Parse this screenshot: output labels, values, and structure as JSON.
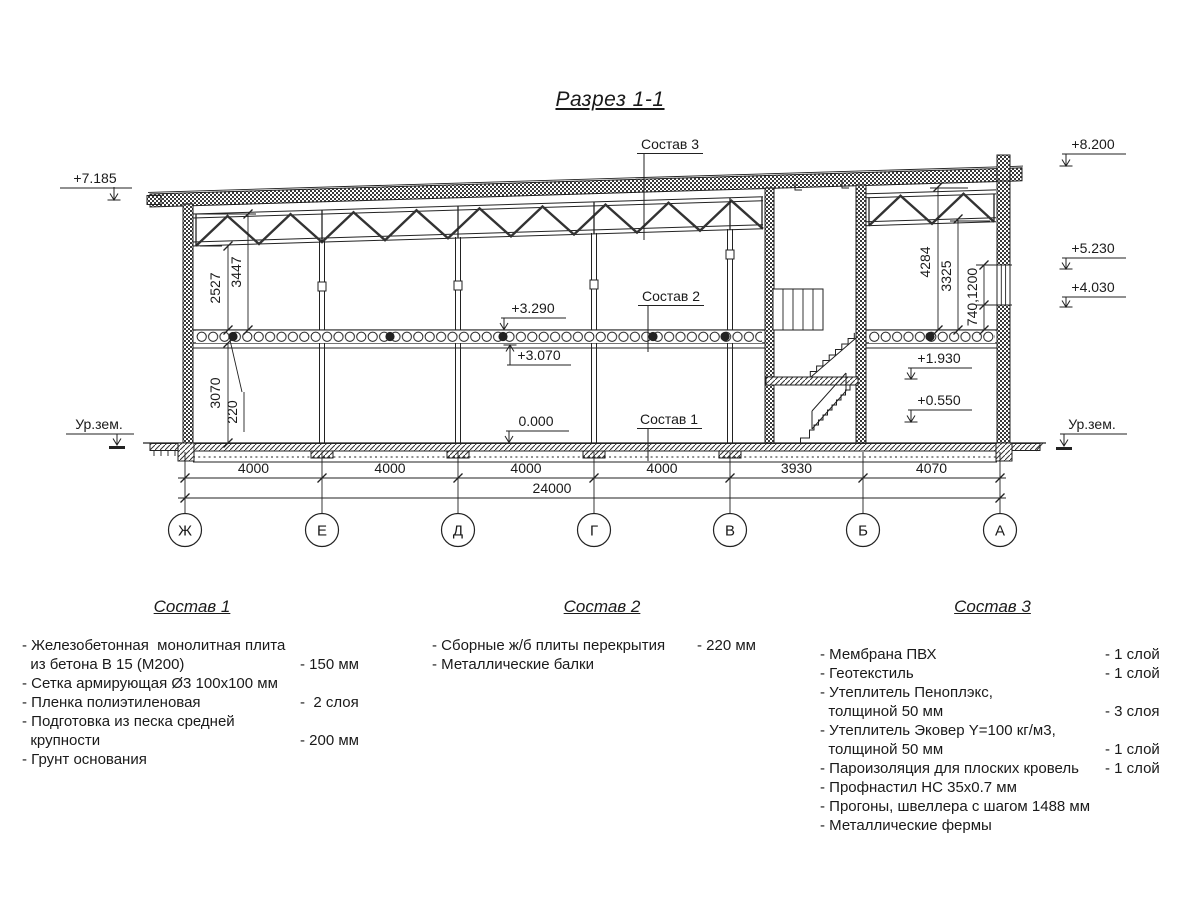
{
  "title": "Разрез 1-1",
  "drawing": {
    "elevations": {
      "left_roof": "+7.185",
      "right_parapet": "+8.200",
      "right_truss": "+5.230",
      "right_window": "+4.030",
      "slab_top": "+3.290",
      "slab_bottom": "+3.070",
      "floor_zero": "0.000",
      "stair_landing": "+1.930",
      "entry_level": "+0.550",
      "ground_left": "Ур.зем.",
      "ground_right": "Ур.зем."
    },
    "section_labels": {
      "s1": "Состав 1",
      "s2": "Состав 2",
      "s3": "Состав 3"
    },
    "dims": {
      "spans": [
        "4000",
        "4000",
        "4000",
        "4000",
        "3930",
        "4070"
      ],
      "total": "24000",
      "left_vertical": [
        "2527",
        "3447",
        "220",
        "3070"
      ],
      "right_vertical": [
        "4284",
        "3325",
        "740,1200"
      ]
    },
    "axes": [
      "Ж",
      "Е",
      "Д",
      "Г",
      "В",
      "Б",
      "А"
    ]
  },
  "compositions": [
    {
      "title": "Состав 1",
      "rows": [
        {
          "t": "- Железобетонная  монолитная плита",
          "v": ""
        },
        {
          "t": "  из бетона В 15 (М200)",
          "v": "- 150 мм"
        },
        {
          "t": "- Сетка армирующая Ø3 100x100 мм",
          "v": ""
        },
        {
          "t": "- Пленка полиэтиленовая",
          "v": "-  2 слоя"
        },
        {
          "t": "- Подготовка из песка средней",
          "v": ""
        },
        {
          "t": "  крупности",
          "v": "- 200 мм"
        },
        {
          "t": "- Грунт основания",
          "v": ""
        }
      ]
    },
    {
      "title": "Состав 2",
      "rows": [
        {
          "t": "- Сборные ж/б плиты перекрытия",
          "v": "- 220 мм"
        },
        {
          "t": "- Металлические балки",
          "v": ""
        }
      ]
    },
    {
      "title": "Состав 3",
      "rows": [
        {
          "t": "- Мембрана ПВХ",
          "v": "- 1 слой"
        },
        {
          "t": "- Геотекстиль",
          "v": "- 1 слой"
        },
        {
          "t": "- Утеплитель Пеноплэкс,",
          "v": ""
        },
        {
          "t": "  толщиной 50 мм",
          "v": "- 3 слоя"
        },
        {
          "t": "- Утеплитель Эковер Y=100 кг/м3,",
          "v": ""
        },
        {
          "t": "  толщиной 50 мм",
          "v": "- 1 слой"
        },
        {
          "t": "- Пароизоляция для плоских кровель",
          "v": "- 1 слой"
        },
        {
          "t": "- Профнастил НС 35x0.7 мм",
          "v": ""
        },
        {
          "t": "- Прогоны, швеллера с шагом 1488 мм",
          "v": ""
        },
        {
          "t": "- Металлические фермы",
          "v": ""
        }
      ]
    }
  ]
}
